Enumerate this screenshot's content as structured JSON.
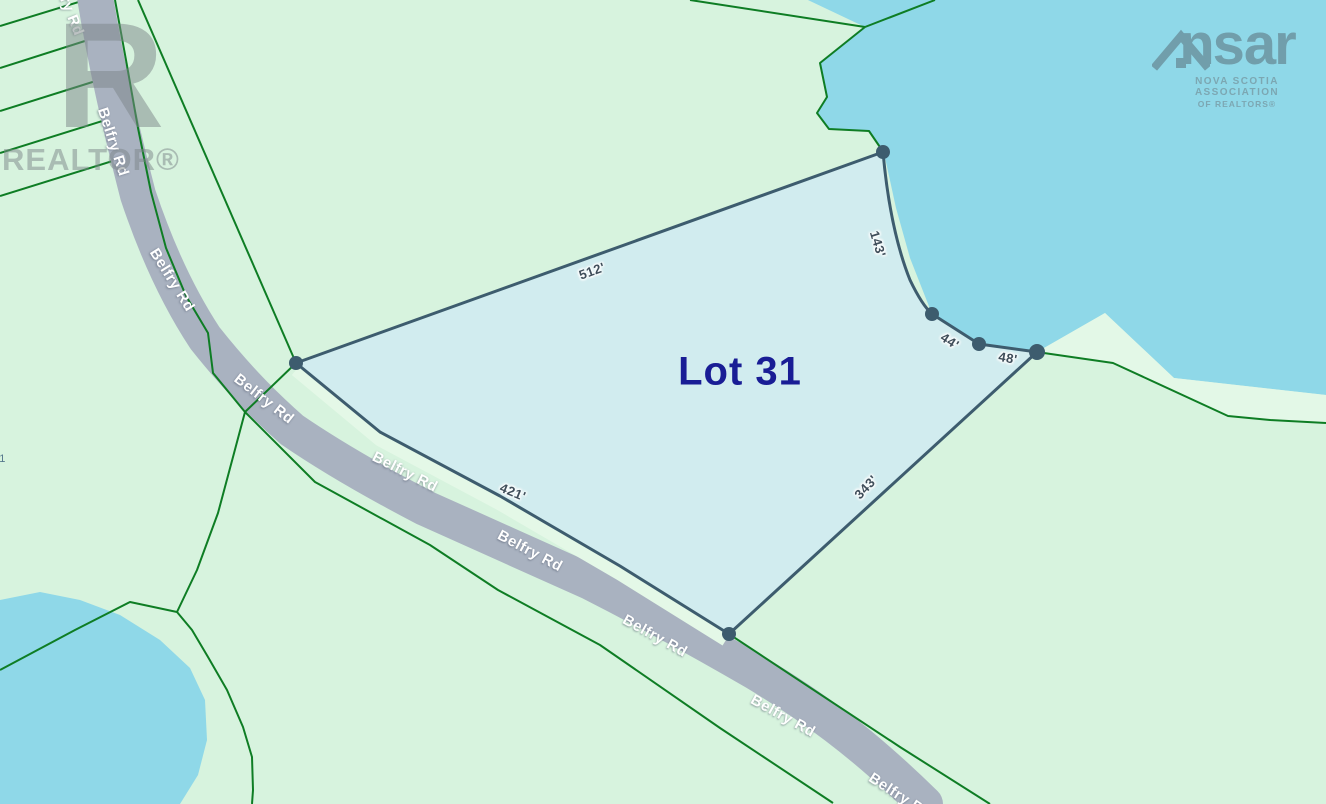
{
  "map": {
    "lot_label": "Lot 31",
    "civic_number_partial": "11",
    "road_name": "Belfry Rd",
    "measurements": [
      {
        "text": "512'"
      },
      {
        "text": "143'"
      },
      {
        "text": "44'"
      },
      {
        "text": "48'"
      },
      {
        "text": "343'"
      },
      {
        "text": "421'"
      }
    ],
    "road_labels": [
      {
        "text": "Belfry Rd"
      },
      {
        "text": "Belfry Rd"
      },
      {
        "text": "Belfry Rd"
      },
      {
        "text": "Belfry Rd"
      },
      {
        "text": "Belfry Rd"
      },
      {
        "text": "Belfry Rd"
      },
      {
        "text": "Belfry Rd"
      },
      {
        "text": "Belfry Rd"
      },
      {
        "text": "Belfry Rd"
      }
    ]
  },
  "watermarks": {
    "realtor": {
      "letter": "R",
      "text": "REALTOR®"
    },
    "nsar": {
      "wordmark_left": "ns",
      "wordmark_right": "ar",
      "line1": "NOVA SCOTIA ASSOCIATION",
      "line2": "OF REALTORS®"
    }
  },
  "colors": {
    "land": "#d7f3de",
    "water": "#8fd8e8",
    "lot_fill": "#cfeaf3",
    "lot_stroke": "#3d5c6e",
    "road": "#a9b2c0",
    "cadastral_line": "#0e7d24",
    "lot_text": "#191d95",
    "measurement_text": "#3f4e5a"
  }
}
